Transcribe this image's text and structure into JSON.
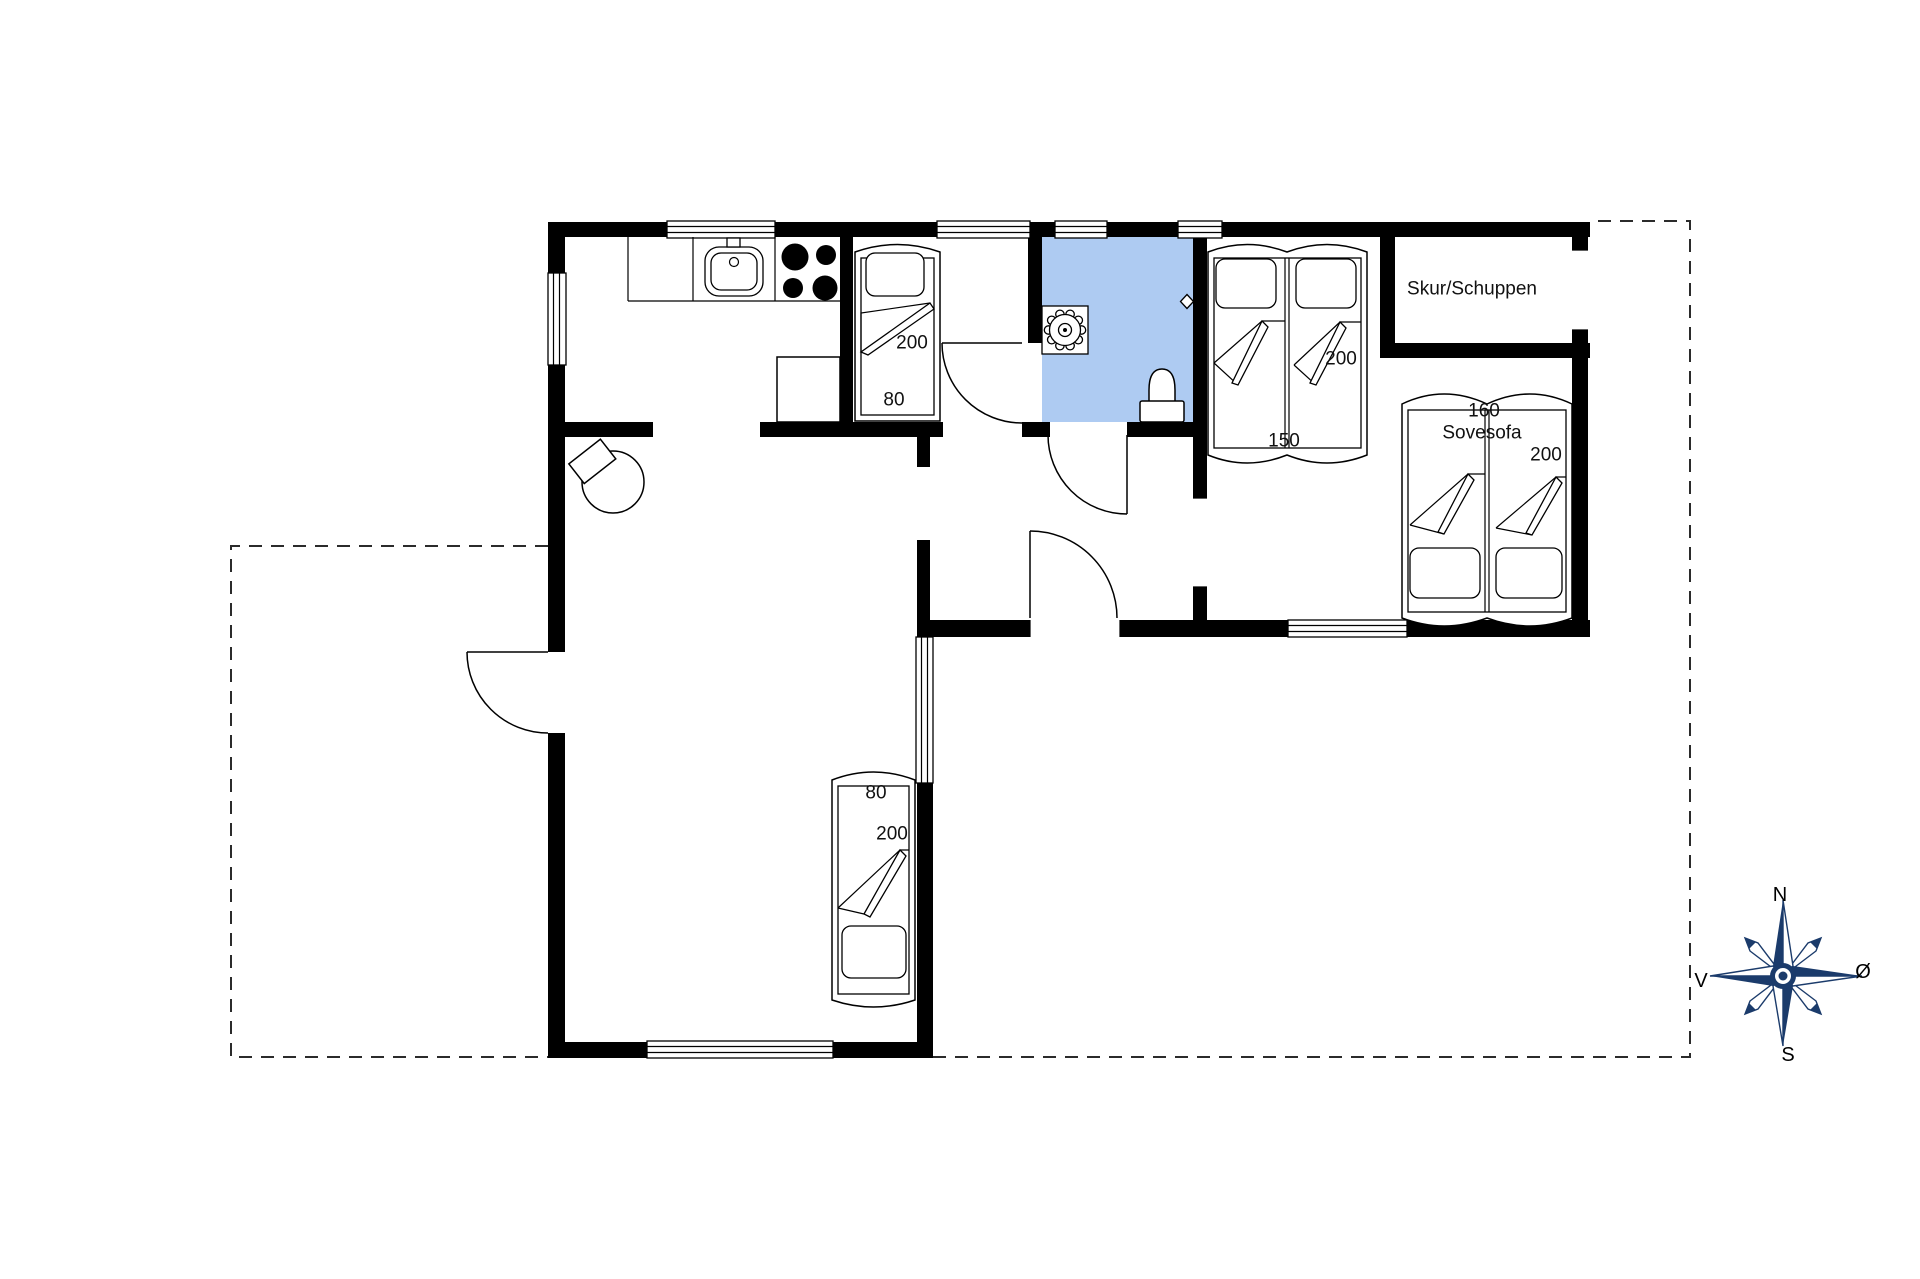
{
  "floorplan": {
    "shed_label": "Skur/Schuppen",
    "bedroom1_bed": {
      "length": "200",
      "width": "80"
    },
    "bedroom2_bed": {
      "length": "200",
      "width": "150"
    },
    "sofa_bed": {
      "width": "160",
      "name": "Sovesofa",
      "length": "200"
    },
    "living_room_bed": {
      "width": "80",
      "length": "200"
    },
    "compass": {
      "north": "N",
      "east": "Ø",
      "south": "S",
      "west": "V"
    },
    "colors": {
      "background": "#ffffff",
      "wall": "#000000",
      "bathroom_floor": "#aecbf2",
      "compass_navy": "#1b3b6b"
    }
  }
}
